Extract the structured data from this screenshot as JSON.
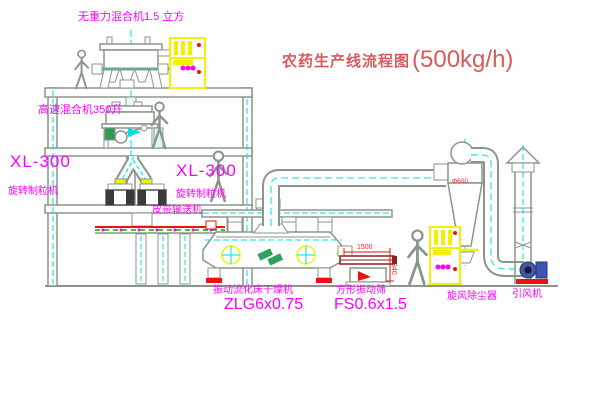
{
  "title": {
    "text": "农药生产线流程图",
    "capacity": "(500kg/h)"
  },
  "labels": {
    "top_mixer": "无重力混合机1.5 立方",
    "high_speed_mixer": "高速混合机350升",
    "granulator_model_left": "XL-300",
    "granulator_name_left": "旋转制粒机",
    "granulator_model_mid": "XL-300",
    "granulator_name_mid": "旋转制粒机",
    "belt_conveyor": "皮带输送机",
    "dryer_name": "振动流化床干燥机",
    "dryer_model": "ZLG6x0.75",
    "screen_name": "方形振动筛",
    "screen_model": "FS0.6x1.5",
    "cyclone": "旋风除尘器",
    "fan": "引风机"
  },
  "dimensions": {
    "screen_length": "1500",
    "screen_height": "340",
    "cyclone_dia": "Φ600"
  },
  "colors": {
    "line": "#93a093",
    "centerline": "#00dede",
    "cabinet": "#f2f200",
    "label": "#ff00ff",
    "dimension": "#ff2222",
    "title": "#d85a5a",
    "belt_green": "#00b000",
    "fan_blue": "#3b55b0",
    "base_red": "#ee1111"
  }
}
